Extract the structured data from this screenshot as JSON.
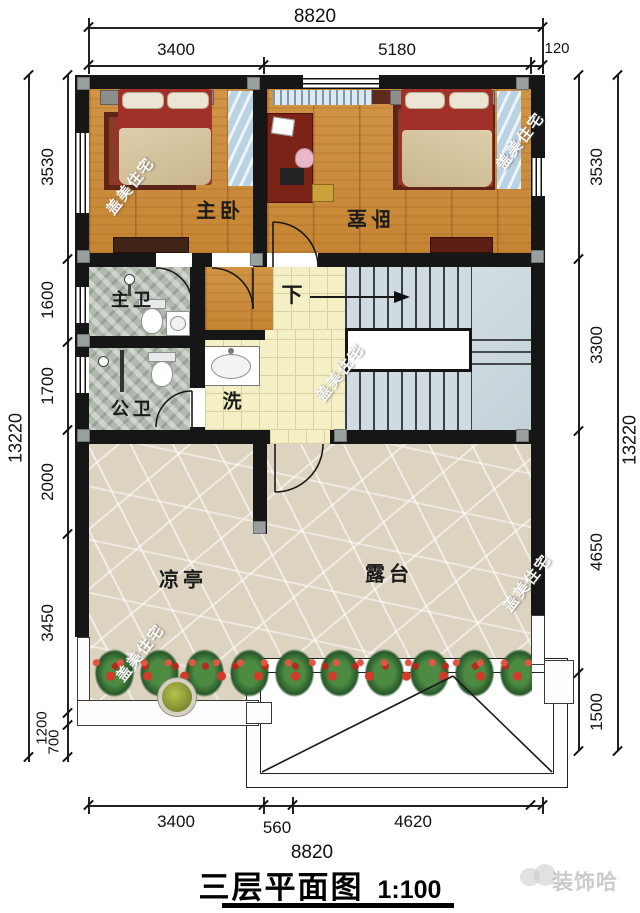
{
  "title": {
    "name": "三层平面图",
    "scale": "1:100"
  },
  "dimensions": {
    "top": {
      "total": "8820",
      "seg1": "3400",
      "seg2": "5180",
      "seg3": "120"
    },
    "bottom": {
      "total": "8820",
      "seg1": "3400",
      "seg2": "560",
      "seg3": "4620"
    },
    "left": {
      "total": "13220",
      "seg1": "3530",
      "seg2": "1600",
      "seg3": "1700",
      "seg4": "2000",
      "seg5": "3450",
      "seg6": "1200",
      "seg7": "700"
    },
    "right": {
      "total": "13220",
      "seg1": "3530",
      "seg2": "3300",
      "seg3": "4650",
      "seg4": "1500"
    }
  },
  "rooms": {
    "master_bedroom": "主卧",
    "bedroom": "卧室",
    "master_bath": "主卫",
    "public_bath": "公卫",
    "wash": "洗",
    "pavilion": "凉亭",
    "terrace": "露台"
  },
  "stairs": {
    "down": "下"
  },
  "watermark": {
    "text": "盖美住宅",
    "brand": "装饰哈"
  },
  "colors": {
    "wall": "#161616",
    "wood": "#c98a3e",
    "tile": "#f5efc5",
    "stone": "#ddd3c1",
    "stair": "#ccd8dd",
    "accent_red": "#9c2f24"
  }
}
